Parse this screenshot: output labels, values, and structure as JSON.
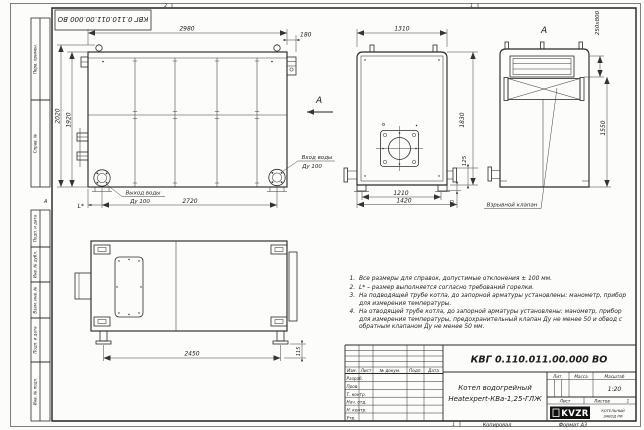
{
  "sheet": {
    "stamp": "КВГ 0.110.011.00.000 ВО",
    "zone_top_left": "2",
    "zone_top_right": "1",
    "zone_bottom": "1",
    "fold_mark": "А",
    "copied": "Копировал",
    "format": "Формат А3"
  },
  "margin": {
    "perv_primen": "Перв. примен.",
    "sprav_no": "Справ. №",
    "podp_data_1": "Подп. и дата",
    "inv_dubl": "Инв. № дубл.",
    "vzam_inv": "Взам. инв. №",
    "podp_data_2": "Подп. и дата",
    "inv_podl": "Инв. № подл."
  },
  "views": {
    "side": {
      "dim_2980": "2980",
      "dim_180": "180",
      "dim_2020": "2020",
      "dim_1920": "1920",
      "dim_2720": "2720",
      "dim_L": "L*",
      "outlet_line1": "Выход воды",
      "outlet_line2": "Ду 100",
      "inlet_line1": "Вход воды",
      "inlet_line2": "Ду 100",
      "arrow_label": "А"
    },
    "front": {
      "dim_1310": "1310",
      "dim_1830": "1830",
      "dim_125": "125",
      "dim_1210": "1210",
      "dim_1420": "1420",
      "dim_90": "90"
    },
    "view_a": {
      "label": "А",
      "dim_250x800": "250х800",
      "dim_1550": "1550",
      "valve_label": "Взрывной клапан"
    },
    "side_opposite": {
      "dim_2450": "2450",
      "dim_115": "115"
    }
  },
  "notes": {
    "items": [
      "Все размеры для справок, допустимые отклонения ± 100 мм.",
      "L* – размер выполняется согласно требований горелки.",
      "На подводящей трубе котла, до запорной арматуры установлены: манометр, прибор для измерения температуры.",
      "На отводящей трубе котла, до запорной арматуры установлены: манометр, прибор для измерения температуры, предохранительный клапан Ду не менее 50 и обвод с обратным клапаном Ду не менее 50 мм."
    ]
  },
  "title_block": {
    "doc_number": "КВГ 0.110.011.00.000 ВО",
    "product_line1": "Котел водогрейный",
    "product_line2": "Heatexpert-КВа-1,25-ГЛЖ",
    "col_izm": "Изм.",
    "col_list": "Лист",
    "col_doc": "№ докум.",
    "col_podp": "Подп.",
    "col_data": "Дата",
    "rows": [
      "Разраб.",
      "Пров.",
      "Т. контр.",
      "Нач. отд.",
      "Н. контр.",
      "Утв."
    ],
    "lit_label": "Лит.",
    "mass_label": "Масса",
    "scale_label": "Масштаб",
    "scale_value": "1:20",
    "sheet_label": "Лист",
    "sheets_label": "Листов",
    "sheets_value": "1",
    "logo_text": "KVZR",
    "logo_caption1": "КОТЕЛЬНЫЙ",
    "logo_caption2": "ЗАВОД РФ"
  }
}
